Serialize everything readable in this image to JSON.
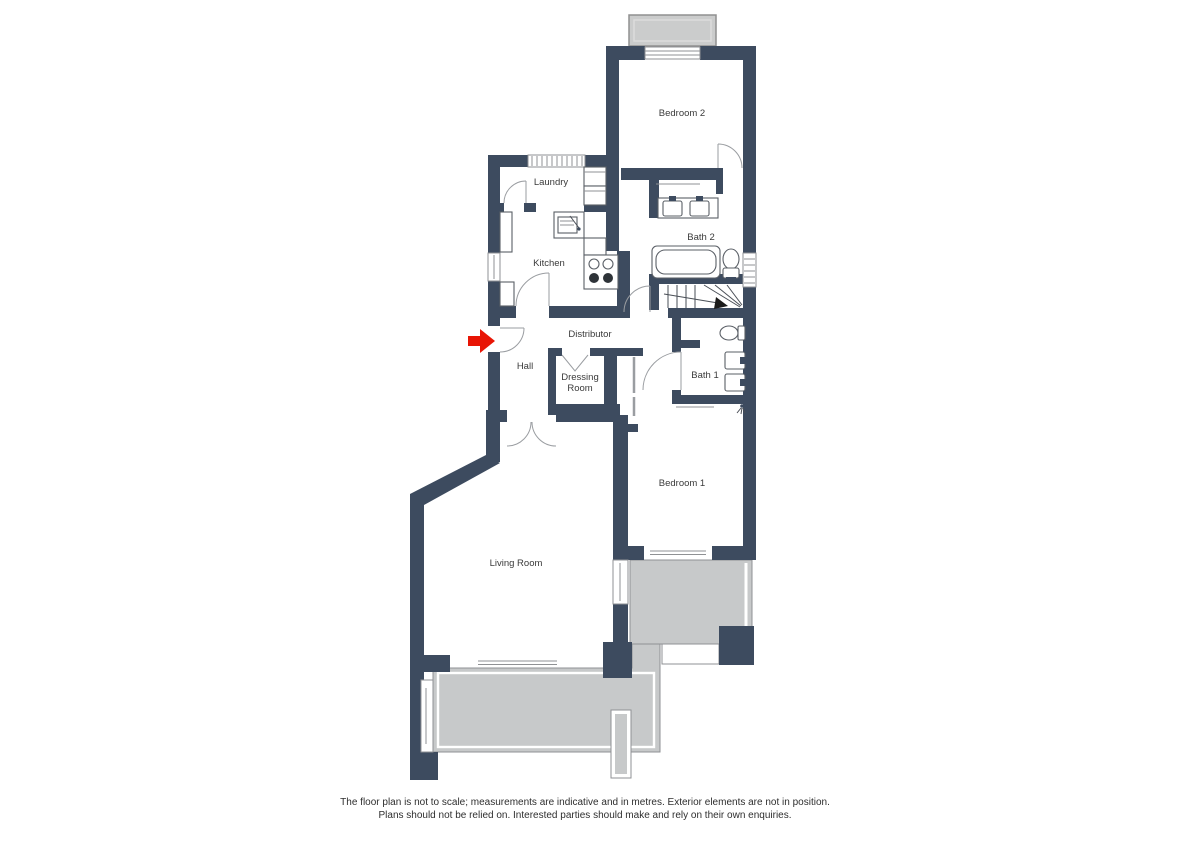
{
  "colors": {
    "walls": "#3d4b5f",
    "terrace": "#c7c9ca",
    "terrace_stroke": "#8f9194",
    "balcony": "#cbcccc",
    "accent_arrow": "#e81505"
  },
  "rooms": {
    "bedroom2": "Bedroom 2",
    "laundry": "Laundry",
    "kitchen": "Kitchen",
    "bath2": "Bath 2",
    "distributor": "Distributor",
    "hall": "Hall",
    "dressing_line1": "Dressing",
    "dressing_line2": "Room",
    "bath1": "Bath 1",
    "bedroom1": "Bedroom 1",
    "living": "Living Room"
  },
  "disclaimer": {
    "line1": "The floor plan is not to scale; measurements are indicative and in metres. Exterior elements are not in position.",
    "line2": "Plans should not be relied on. Interested parties should make and rely on their own enquiries."
  }
}
